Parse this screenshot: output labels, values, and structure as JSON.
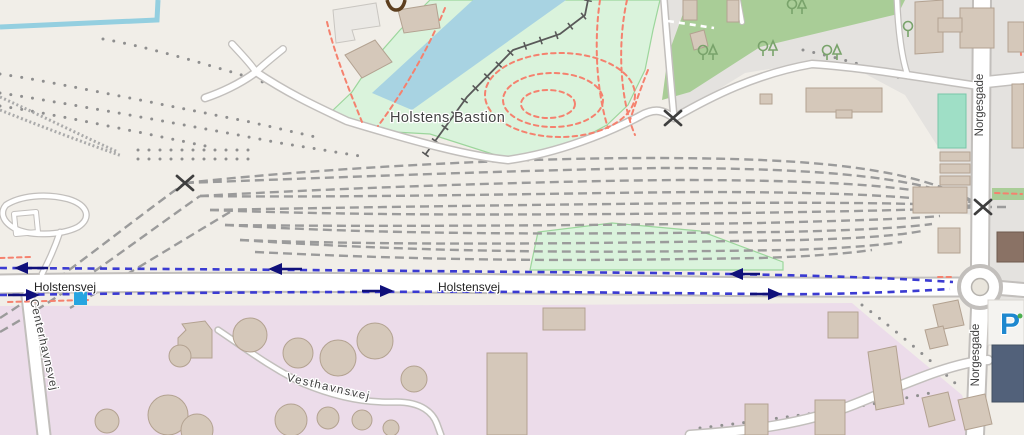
{
  "map": {
    "labels": {
      "bastion": "Holstens Bastion",
      "holstensvej_left": "Holstensvej",
      "holstensvej_center": "Holstensvej",
      "norgesgade_top": "Norgesgade",
      "norgesgade_bottom": "Norgesgade",
      "vesthavnsvej": "Vesthavnsvej",
      "centerhavnsvej": "Centerhavnsvej",
      "parking": "P"
    },
    "icons": {
      "level_crossing": "x-cross-marker",
      "cycle_route_arrows": "one-way-arrows",
      "blue_square_marker": "crossing-square",
      "parking_symbol": "parking-P"
    }
  },
  "colors": {
    "land": "#f1eee8",
    "residential": "#e4e2df",
    "greenarea": "#a9cd97",
    "park": "#daf3dc",
    "parkBorder": "#9cd69c",
    "water": "#a8d3e2",
    "waterLine": "#94cfe0",
    "industrial": "#ecdcea",
    "building": "#d5c8ba",
    "buildingStroke": "#b3a291",
    "grayBldg": "#ebe9e5",
    "darkSlate": "#52617a",
    "darkBldg": "#8a7265",
    "pitch": "#9fdfc6",
    "pitchStroke": "#79c7a8",
    "roadFill": "#ffffff",
    "roadCasing": "#c2bfbc",
    "rail": "#9b9b9b",
    "railDot": "#8f8f8f",
    "embankment": "#595959",
    "routeBlue": "#3b3bd2",
    "routeArrow": "#10107a",
    "pathRed": "#f5816e",
    "label": "#3b3b3b",
    "crossing": "#3f3f3f",
    "parkingBlue": "#1e88cf",
    "markerBlue": "#27a5e0",
    "tree": "#79a36b",
    "dotGreen": "#4caf50"
  }
}
